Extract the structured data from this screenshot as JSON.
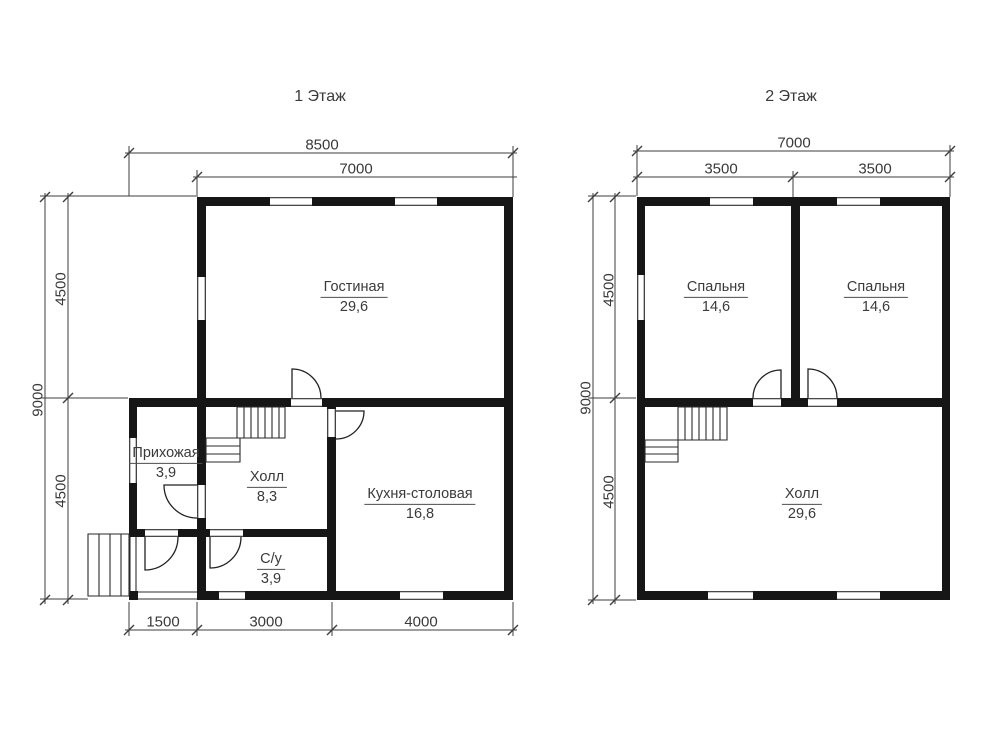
{
  "floor1": {
    "title": "1 Этаж",
    "dims": {
      "width_total": "8500",
      "width_top": "7000",
      "height_total": "9000",
      "height_upper": "4500",
      "height_lower": "4500",
      "bottom_porch": "1500",
      "bottom_mid": "3000",
      "bottom_right": "4000"
    },
    "rooms": {
      "living": {
        "name": "Гостиная",
        "area": "29,6"
      },
      "entry": {
        "name": "Прихожая",
        "area": "3,9"
      },
      "hall": {
        "name": "Холл",
        "area": "8,3"
      },
      "kitchen": {
        "name": "Кухня-столовая",
        "area": "16,8"
      },
      "bathroom": {
        "name": "С/у",
        "area": "3,9"
      }
    }
  },
  "floor2": {
    "title": "2 Этаж",
    "dims": {
      "width_total": "7000",
      "width_left": "3500",
      "width_right": "3500",
      "height_total": "9000",
      "height_upper": "4500",
      "height_lower": "4500"
    },
    "rooms": {
      "bedroom_left": {
        "name": "Спальня",
        "area": "14,6"
      },
      "bedroom_right": {
        "name": "Спальня",
        "area": "14,6"
      },
      "hall": {
        "name": "Холл",
        "area": "29,6"
      }
    }
  },
  "colors": {
    "wall": "#161616",
    "detail_line": "#2e2e2e",
    "dim_line": "#3d3d3d",
    "text": "#3a3a3a",
    "background": "#ffffff"
  }
}
